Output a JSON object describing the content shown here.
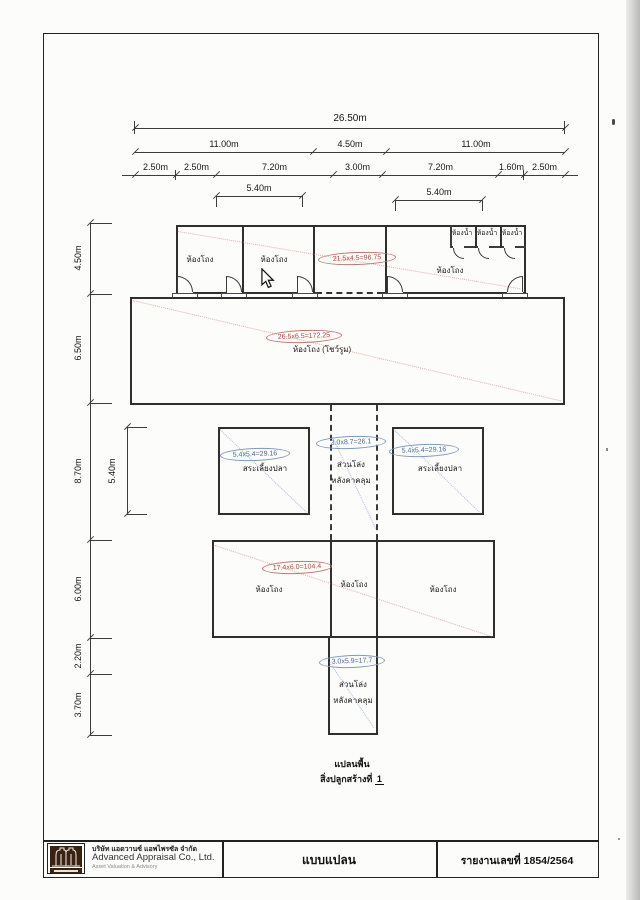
{
  "dims": {
    "top": {
      "row1": "26.50m",
      "row2": [
        "11.00m",
        "4.50m",
        "11.00m"
      ],
      "row3": [
        "2.50m",
        "2.50m",
        "7.20m",
        "3.00m",
        "7.20m",
        "1.60m",
        "2.50m"
      ],
      "row4": [
        "5.40m",
        "5.40m"
      ]
    },
    "left": [
      "4.50m",
      "6.50m",
      "8.70m",
      "6.00m",
      "2.20m",
      "3.70m"
    ],
    "pond_height": "5.40m"
  },
  "rooms": {
    "hall": "ห้องโถง",
    "hall_showroom": "ห้องโถง (โชว์รูม)",
    "bathroom": "ห้องน้ำ",
    "fish_pond": "สระเลี้ยงปลา",
    "open_covered_1": "ส่วนโล่ง",
    "open_covered_2": "หลังคาคลุม"
  },
  "annotations": {
    "red_top_row": "21.5x4.5=96.75",
    "red_hall": "26.5x6.5=172.25",
    "red_lower": "17.4x6.0=104.4",
    "blue_pond_left": "5.4x5.4=29.16",
    "blue_pond_right": "5.4x5.4=29.16",
    "blue_corridor": "3.0x8.7=26.1",
    "blue_bottom": "3.0x5.9=17.7"
  },
  "caption": {
    "line1": "แปลนพื้น",
    "line2": "สิ่งปลูกสร้างที่",
    "line2_num": "1"
  },
  "titleblock": {
    "company_th": "บริษัท แอดวานซ์ แอพไพรซัล จำกัด",
    "company_en": "Advanced Appraisal Co., Ltd.",
    "company_sub": "Asset Valuation & Advisory",
    "sheet_title": "แบบแปลน",
    "report_no": "รายงานเลขที่ 1854/2564",
    "logo_icon": "building-logo-icon"
  },
  "colors": {
    "red_annotation": "#b5443d",
    "blue_annotation": "#49699c",
    "wall": "#2f2f2f",
    "logo_bg": "#3a2213"
  }
}
